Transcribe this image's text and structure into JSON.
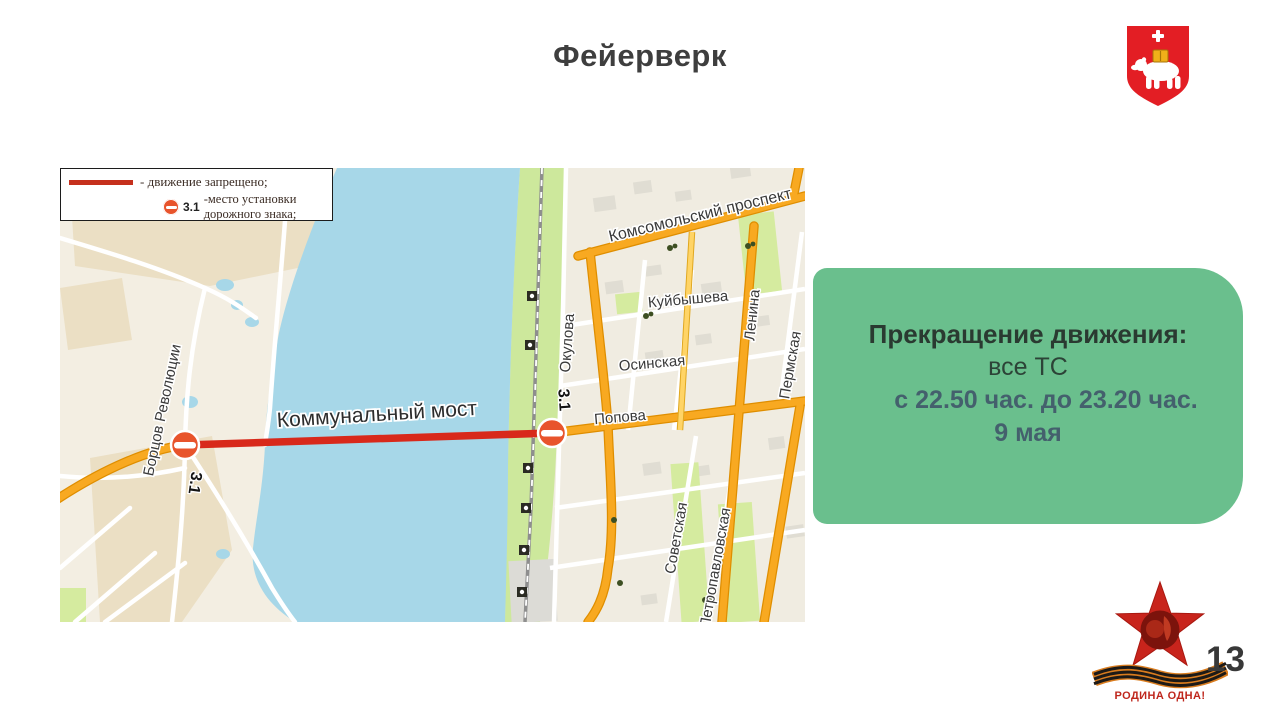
{
  "slide": {
    "title": "Фейерверк",
    "page_number": "13"
  },
  "legend": {
    "items": [
      {
        "label": "- движение запрещено;"
      },
      {
        "sign_code": "3.1",
        "label": "-место установки дорожного знака;"
      }
    ]
  },
  "map": {
    "bridge_label": "Коммунальный мост",
    "signs": {
      "left_code": "3.1",
      "right_code": "3.1"
    },
    "streets": {
      "bortsov_revolyutsii": "Борцов Революции",
      "komsomolsky_prospekt": "Комсомольский проспект",
      "kuybysheva": "Куйбышева",
      "osinskaya": "Осинская",
      "okulova": "Окулова",
      "popova": "Попова",
      "lenina": "Ленина",
      "permskaya": "Пермская",
      "sovetskaya": "Советская",
      "petropavlovskaya": "Петропавловская"
    }
  },
  "info_box": {
    "heading": "Прекращение движения:",
    "line_vehicles": "все ТС",
    "line_time": "с 22.50 час. до 23.20 час.",
    "line_date": "9 мая",
    "bg_color": "#6abf8d"
  },
  "logo": {
    "motto": "РОДИНА ОДНА!"
  },
  "colors": {
    "closure_line": "#d8291b",
    "no_entry_sign": "#e8542c",
    "road_orange": "#f8a921",
    "water_blue": "#a7d7e8",
    "crest_red": "#e31e24",
    "star_red": "#c8241c",
    "info_green": "#6abf8d"
  }
}
